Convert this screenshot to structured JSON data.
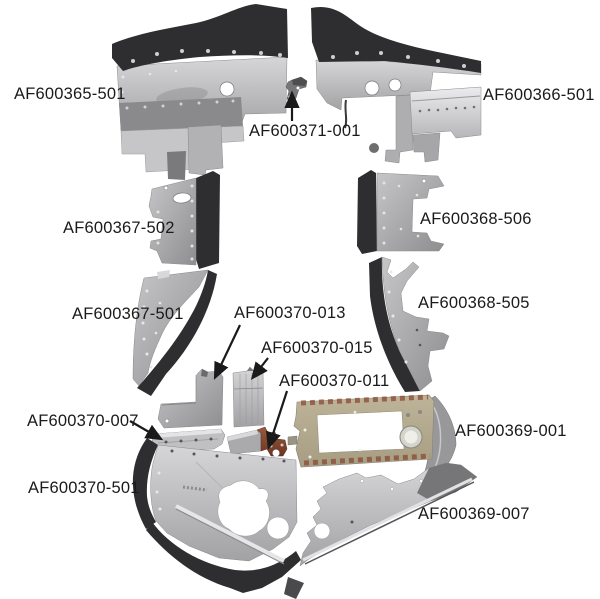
{
  "parts": {
    "af600365_501": {
      "label": "AF600365-501"
    },
    "af600366_501": {
      "label": "AF600366-501"
    },
    "af600371_001": {
      "label": "AF600371-001"
    },
    "af600367_502": {
      "label": "AF600367-502"
    },
    "af600368_506": {
      "label": "AF600368-506"
    },
    "af600367_501": {
      "label": "AF600367-501"
    },
    "af600368_505": {
      "label": "AF600368-505"
    },
    "af600370_013": {
      "label": "AF600370-013"
    },
    "af600370_015": {
      "label": "AF600370-015"
    },
    "af600370_011": {
      "label": "AF600370-011"
    },
    "af600370_007": {
      "label": "AF600370-007"
    },
    "af600369_001": {
      "label": "AF600369-001"
    },
    "af600370_501": {
      "label": "AF600370-501"
    },
    "af600369_007": {
      "label": "AF600369-007"
    }
  },
  "colors": {
    "background": "#ffffff",
    "label_text": "#1a1a1a",
    "dark_metal": "#2e2e30",
    "mid_metal": "#9c9c9e",
    "light_metal": "#cacacc",
    "tan_panel": "#b4ab90",
    "rust_primer": "#8a4a33"
  }
}
